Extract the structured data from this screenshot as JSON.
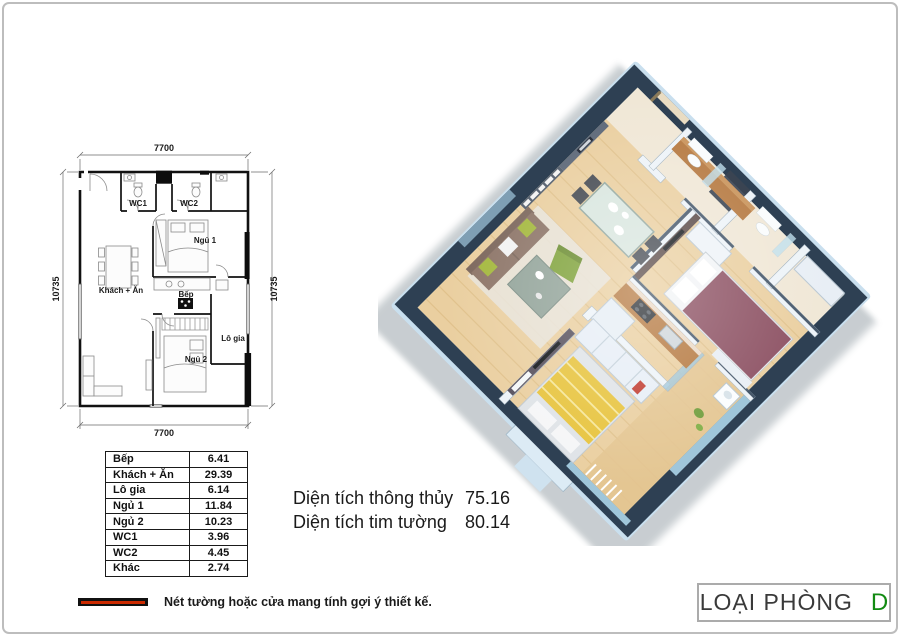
{
  "page": {
    "bg": "#ffffff",
    "border_color": "#bdbdbd"
  },
  "plan2d": {
    "dims": {
      "top": "7700",
      "bottom": "7700",
      "left": "10735",
      "right": "10735"
    },
    "rooms": {
      "wc1": "WC1",
      "wc2": "WC2",
      "ngu1": "Ngủ 1",
      "khach_an": "Khách + Ăn",
      "bep": "Bếp",
      "lo_gia": "Lô gia",
      "ngu2": "Ngủ 2"
    }
  },
  "area_table": {
    "rows": [
      {
        "label": "Bếp",
        "value": "6.41"
      },
      {
        "label": "Khách + Ăn",
        "value": "29.39"
      },
      {
        "label": "Lô gia",
        "value": "6.14"
      },
      {
        "label": "Ngủ 1",
        "value": "11.84"
      },
      {
        "label": "Ngủ 2",
        "value": "10.23"
      },
      {
        "label": "WC1",
        "value": "3.96"
      },
      {
        "label": "WC2",
        "value": "4.45"
      },
      {
        "label": "Khác",
        "value": "2.74"
      }
    ]
  },
  "summary": {
    "rows": [
      {
        "label": "Diện tích thông thủy",
        "value": "75.16"
      },
      {
        "label": "Diện tích tim tường",
        "value": "80.14"
      }
    ]
  },
  "legend": {
    "text": "Nét tường hoặc cửa mang tính gợi ý thiết kế.",
    "swatch_bar_color": "#111111",
    "swatch_core_color": "#cc2a00"
  },
  "room_type": {
    "label": "LOẠI PHÒNG",
    "value": "D",
    "value_color": "#128a12"
  },
  "render3d": {
    "colors": {
      "wall_top": "#2e4053",
      "wall_face": "#c9dfee",
      "floor": "#eacfa0",
      "hall_floor": "#f0e7d6",
      "accent_wall": "#56505c",
      "accent_wall2": "#5a4a47",
      "gallery_wall": "#515c6b",
      "bed1": "#8c5062",
      "bed2_blanket": "#e7c33c",
      "sofa": "#8d7568",
      "armchair": "#7fa23a",
      "cabinet_wood": "#b5783f",
      "glass": "#9fc6da",
      "rug": "#e8e4dc"
    }
  }
}
